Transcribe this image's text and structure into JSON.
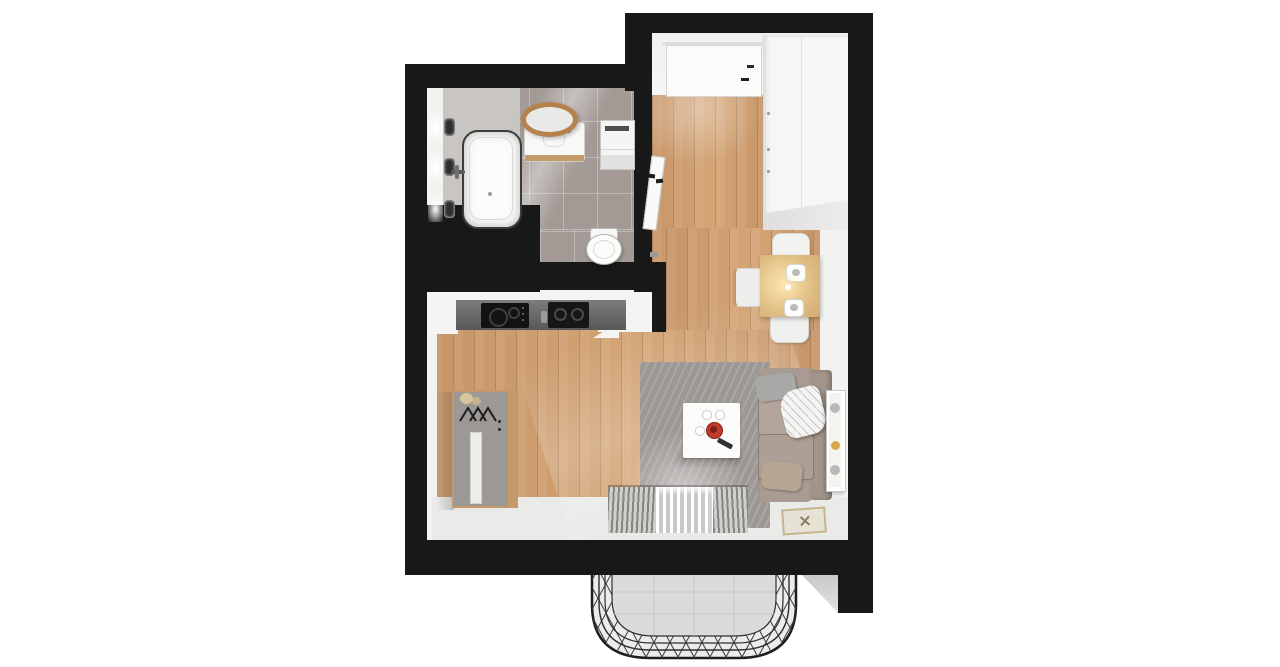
{
  "scene": {
    "kind": "3d-top-down-floor-plan-render",
    "subject": "studio-apartment-with-balcony",
    "rooms": [
      {
        "name": "bathroom",
        "furniture": [
          "bathtub",
          "bath-faucet",
          "wall-sconce",
          "wall-sconce",
          "wall-sconce",
          "round-wood-mirror",
          "sink-vanity",
          "washing-machine",
          "toilet"
        ]
      },
      {
        "name": "entry-hall",
        "furniture": [
          "entrance-door",
          "wardrobe-closet",
          "bathroom-door",
          "shoes"
        ]
      },
      {
        "name": "kitchen",
        "furniture": [
          "upper-cabinets",
          "countertop",
          "induction-cooktop",
          "kitchen-sink"
        ]
      },
      {
        "name": "living-room",
        "furniture": [
          "coat-rack-cabinet",
          "area-rug",
          "coffee-table",
          "red-bowl",
          "remote-control",
          "cups",
          "sofa",
          "gray-pillow",
          "white-blanket",
          "beige-pillow",
          "wall-poster",
          "dining-table",
          "dinner-plate",
          "dinner-plate",
          "chair",
          "chair",
          "chair",
          "doormat",
          "curtains",
          "window"
        ]
      },
      {
        "name": "balcony",
        "furniture": [
          "wireframe-railing",
          "concrete-floor"
        ]
      }
    ]
  },
  "palette": {
    "wall": "#181818",
    "wood": "#c79568",
    "wood_light": "#d4a575",
    "tile": "#a39a95",
    "tile_light": "#c9c5c2",
    "wallface": "#f2f2f0",
    "floor_light": "#eaeae8",
    "rug": "#9d9795",
    "sofa": "#a99b91",
    "cushion": "#b3a59b",
    "table_wood": "#ddba82",
    "table_glow": "#f8e3b0",
    "red": "#c03a2b",
    "yellow": "#d7a94e",
    "balcony_floor": "#dadad8",
    "counter": "#666666",
    "appliance": "#121212",
    "shadow": "#c9c9c7"
  }
}
